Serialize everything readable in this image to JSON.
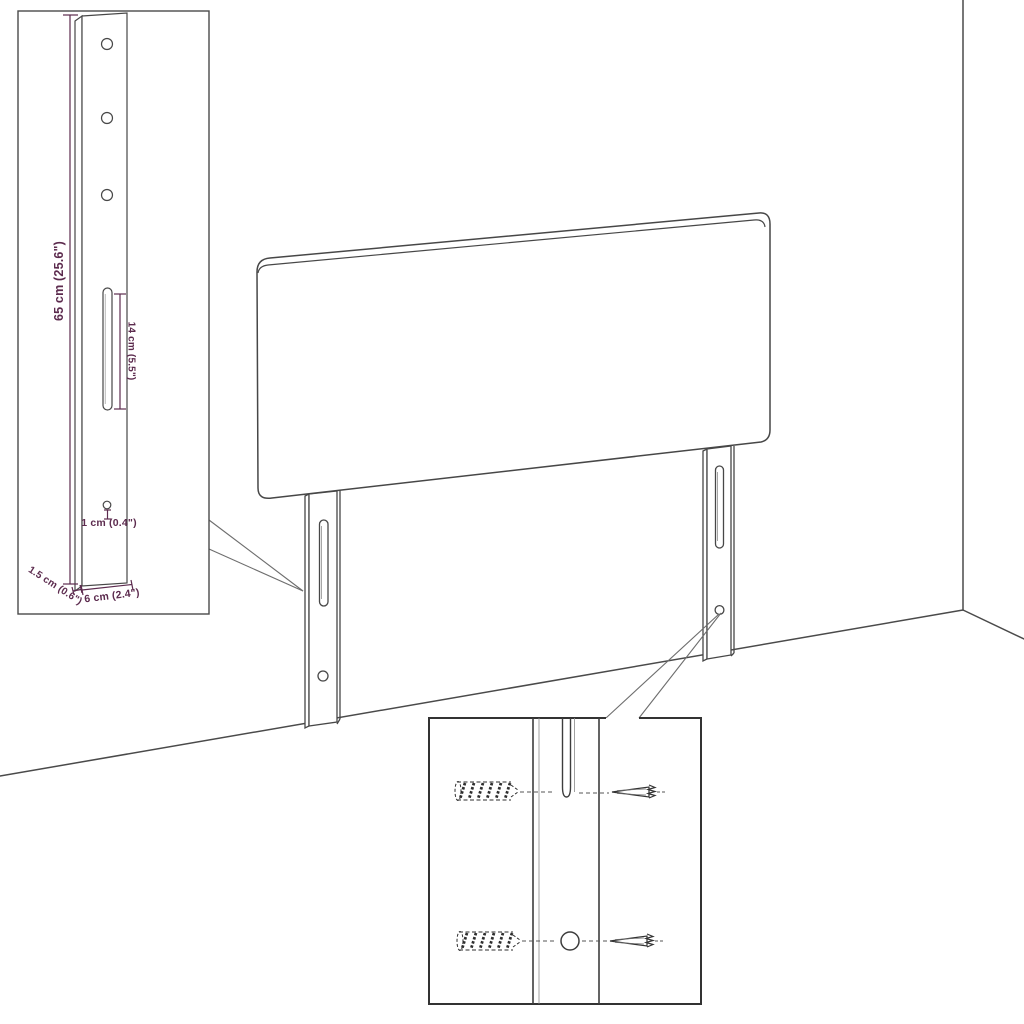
{
  "diagram": {
    "dimension_labels": {
      "bracket_height": "65 cm (25.6\")",
      "slot_length": "14 cm (5.5\")",
      "hole_offset": "1 cm (0.4\")",
      "bracket_thickness": "1.5 cm (0.6\")",
      "bracket_width": "6 cm (2.4\")"
    },
    "colors": {
      "line": "#474747",
      "dimension": "#5c2b4e",
      "background": "#ffffff"
    }
  }
}
